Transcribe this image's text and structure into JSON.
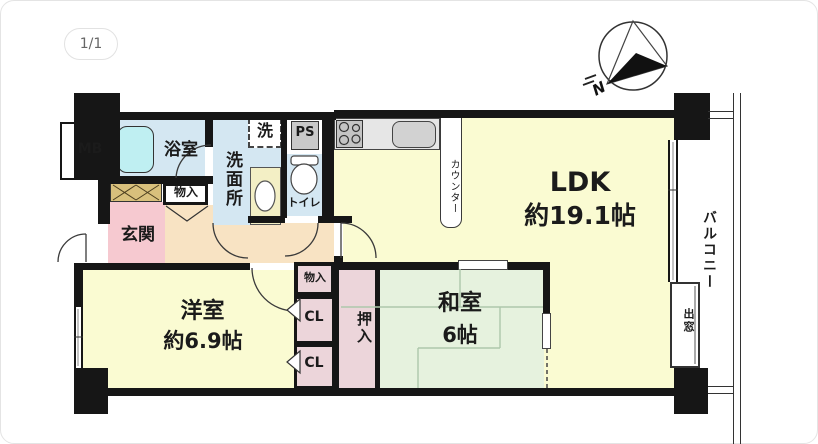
{
  "page": {
    "pagination": "1/1"
  },
  "floorplan": {
    "compass": {
      "north_label": "N"
    },
    "rooms": {
      "ldk": {
        "name": "LDK",
        "size": "約19.1帖"
      },
      "western_room": {
        "name": "洋室",
        "size": "約6.9帖"
      },
      "japanese_room": {
        "name": "和室",
        "size": "6帖"
      },
      "entrance": {
        "name": "玄関"
      },
      "bathroom": {
        "name": "浴室"
      },
      "washroom": {
        "name": "洗面所"
      },
      "toilet": {
        "name": "トイレ"
      },
      "balcony": {
        "name": "バルコニー"
      }
    },
    "features": {
      "washer_space": "洗",
      "pipe_space": "PS",
      "meter_box": "MB",
      "storage_top": "物入",
      "storage_mid": "物入",
      "closet_1": "CL",
      "closet_2": "CL",
      "futon_closet": "押入",
      "counter": "カウンター",
      "bay_window": "出窓"
    },
    "colors": {
      "wall": "#161616",
      "ldk_floor": "#fafbd2",
      "tatami_floor": "#e6f2de",
      "entrance_floor": "#f6c9d0",
      "hallway_floor": "#f8e3c3",
      "wet_area_floor": "#d4e7f2",
      "closet_fill": "#ecd5da",
      "cabinet_fill": "#d8c07c",
      "fixture_gray": "#c9c9c9",
      "bathtub": "#bfeff2"
    }
  }
}
